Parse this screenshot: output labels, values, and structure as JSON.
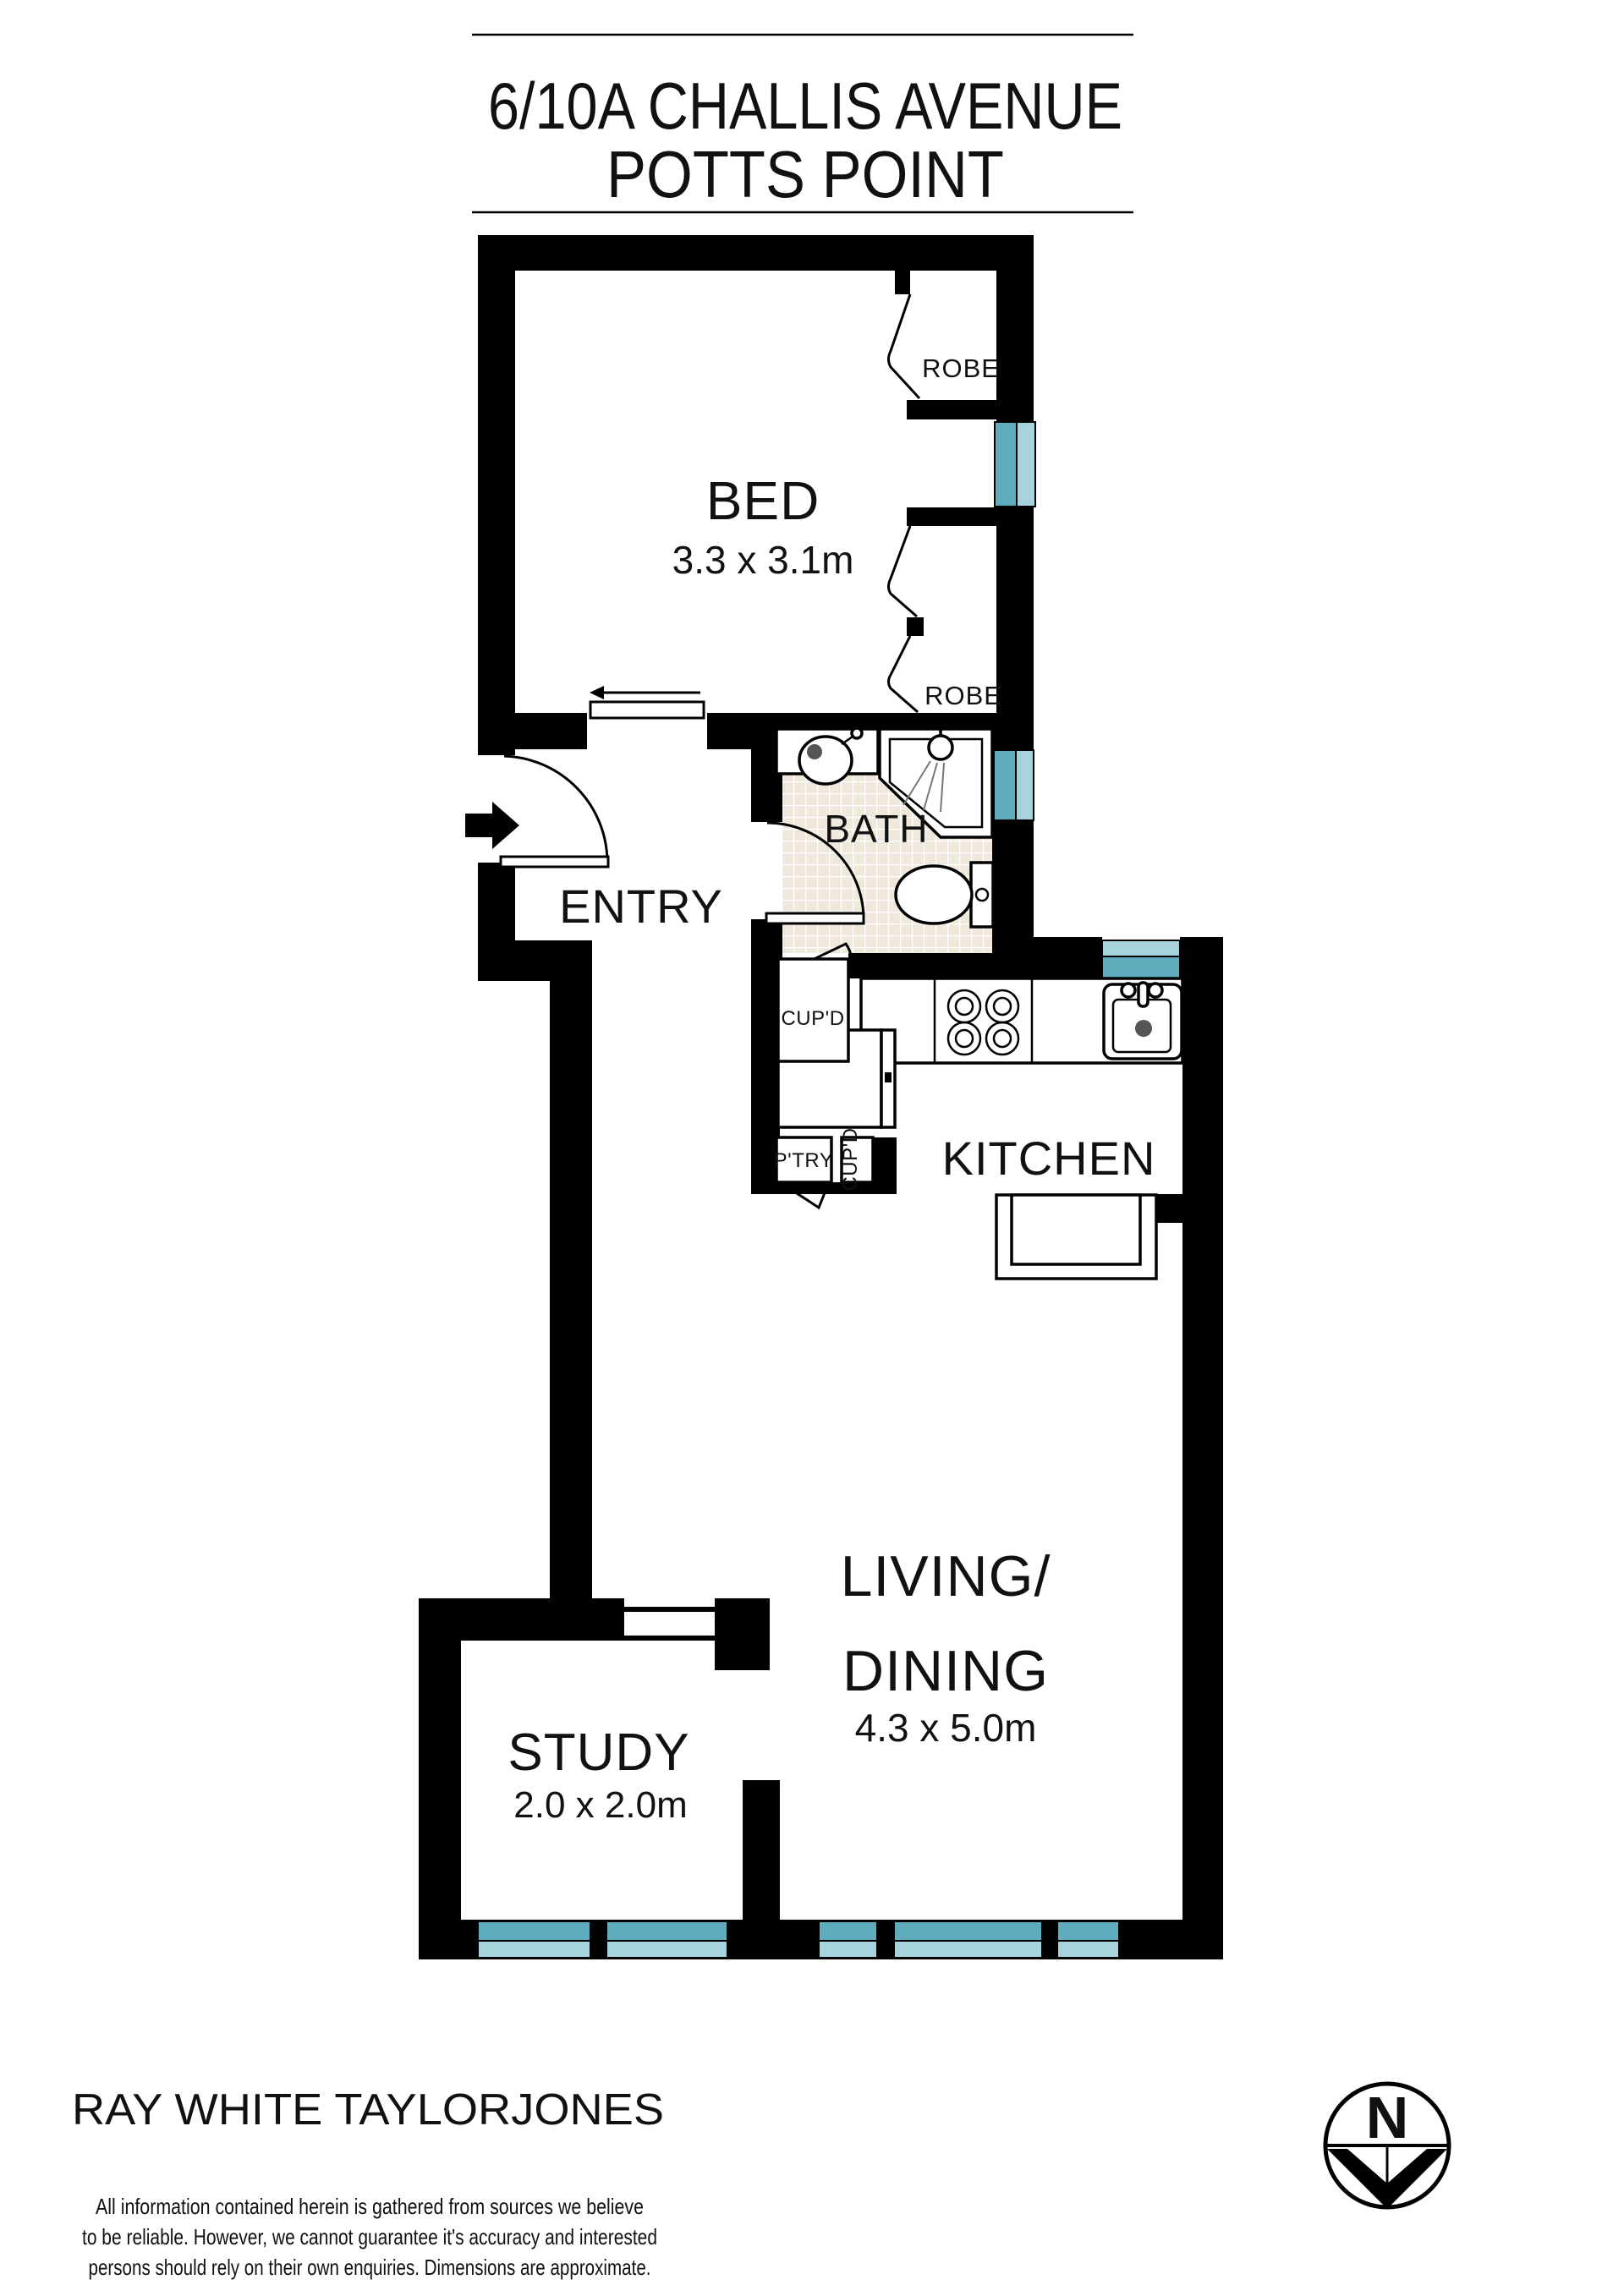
{
  "title": {
    "line1": "6/10A CHALLIS AVENUE",
    "line2": "POTTS POINT"
  },
  "rooms": {
    "bed": {
      "label": "BED",
      "dim": "3.3 x 3.1m"
    },
    "entry": {
      "label": "ENTRY"
    },
    "bath": {
      "label": "BATH"
    },
    "kitchen": {
      "label": "KITCHEN"
    },
    "living": {
      "line1": "LIVING/",
      "line2": "DINING",
      "dim": "4.3 x 5.0m"
    },
    "study": {
      "label": "STUDY",
      "dim": "2.0 x 2.0m"
    }
  },
  "storage": {
    "robe_top": "ROBE",
    "robe_bottom": "ROBE",
    "cupboard_bath": "CUP'D",
    "pantry": "P'TRY",
    "cupboard_kitchen": "CUP'D"
  },
  "compass": {
    "north_label": "N"
  },
  "footer": {
    "agency": "RAY WHITE TAYLORJONES",
    "disclaimer_line1": "All information contained herein is gathered from sources we believe",
    "disclaimer_line2": "to be reliable. However, we cannot guarantee it's accuracy and interested",
    "disclaimer_line3": "persons should rely on their own enquiries. Dimensions are approximate."
  },
  "colors": {
    "wall": "#000000",
    "window_dark": "#5FACBC",
    "window_light": "#A7D3DC",
    "tile": "#F0E8DB",
    "tile_grout": "#FFFFFF",
    "text": "#111111"
  }
}
